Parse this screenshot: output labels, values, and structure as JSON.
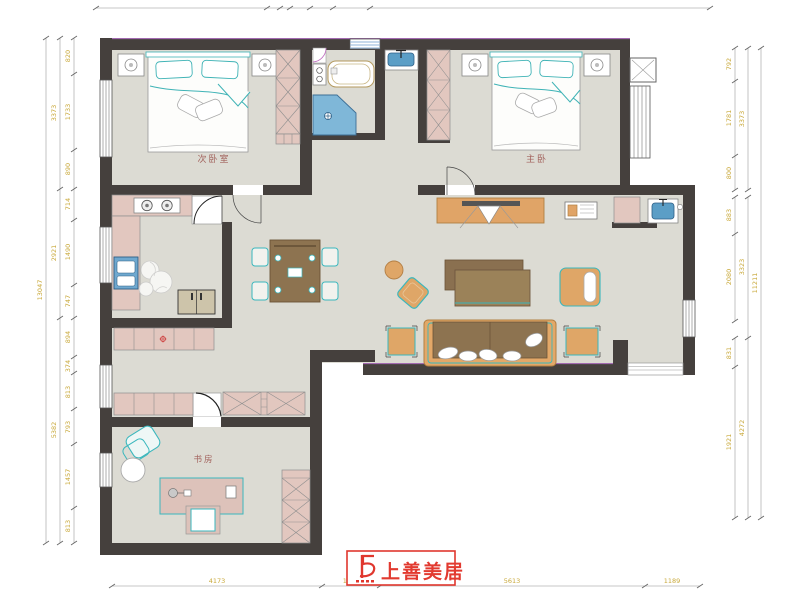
{
  "document": {
    "type": "residential-floor-plan"
  },
  "rooms": {
    "secondary_bedroom": "次卧室",
    "master_bedroom": "主卧",
    "study": "书房"
  },
  "logo": {
    "brand": "上善美居"
  },
  "dimensions": {
    "left_inner": [
      "820",
      "1733",
      "890",
      "714",
      "1490",
      "747",
      "894",
      "374",
      "813",
      "793",
      "1457",
      "813"
    ],
    "left_middle": [
      "3373",
      "2921",
      "5382"
    ],
    "left_total": "13047",
    "right_inner": [
      "792",
      "1781",
      "800",
      "883",
      "2080",
      "831",
      "1921"
    ],
    "right_middle": [
      "3373",
      "3323",
      "4272"
    ],
    "right_total": "11211",
    "bottom": [
      "4173",
      "1238",
      "5613",
      "1189"
    ]
  },
  "colors": {
    "wall": "#45403d",
    "floor": "#dcdbd3",
    "cabinet_pink": "#e2c7bf",
    "furniture_orange": "#e0a467",
    "furniture_brown": "#8d7350",
    "accent_teal": "#3ab7bd",
    "fixture_blue": "#7fb7d8",
    "dimension_text": "#c9a93b",
    "room_label": "#a2625c",
    "brand_red": "#e23a30"
  }
}
